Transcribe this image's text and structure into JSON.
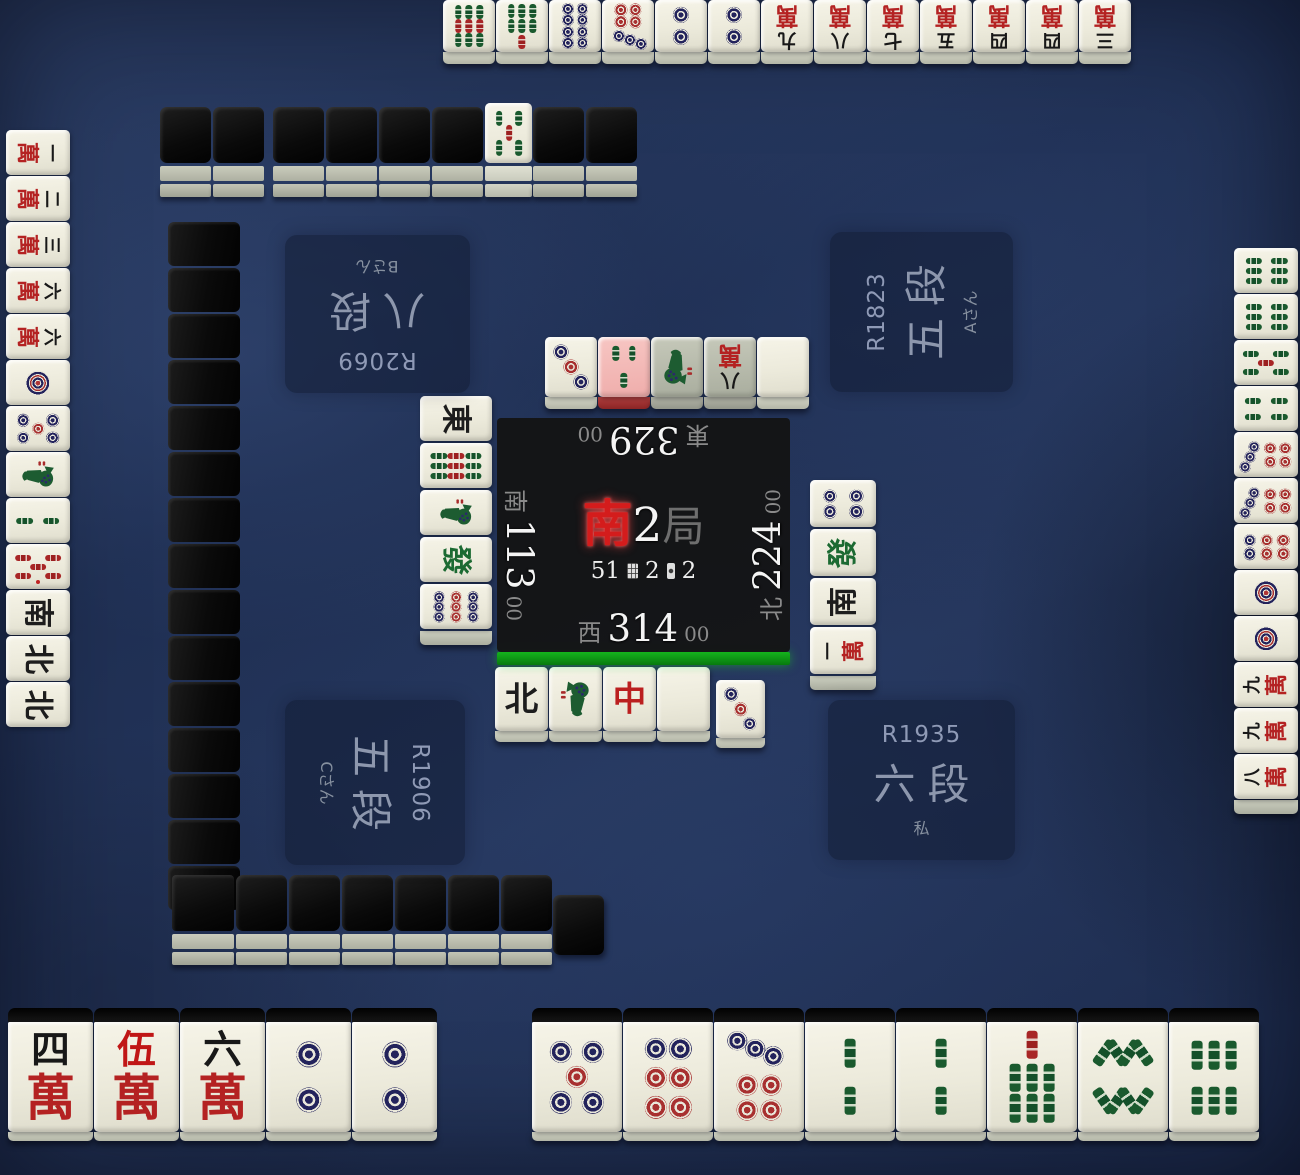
{
  "center": {
    "round": {
      "wind": "南",
      "number": "2",
      "unit": "局"
    },
    "wall_remaining": "51",
    "honba": "2",
    "riichi_sticks": "2"
  },
  "players": {
    "top": {
      "seat_wind": "東",
      "score": "329",
      "score_pad": "00",
      "rate": "R2069",
      "rank": "八段",
      "name": "Bさん"
    },
    "right": {
      "seat_wind": "北",
      "score": "224",
      "score_pad": "00",
      "rate": "R1823",
      "rank": "五段",
      "name": "Aさん"
    },
    "left": {
      "seat_wind": "南",
      "score": "113",
      "score_pad": "00",
      "rate": "R1906",
      "rank": "五段",
      "name": "Cさん"
    },
    "bottom": {
      "seat_wind": "西",
      "score": "314",
      "score_pad": "00",
      "rate": "R1935",
      "rank": "六段",
      "name": "私",
      "active": true
    }
  },
  "hands": {
    "top": [
      "9s",
      "7s",
      "8p",
      "7p",
      "2p",
      "2p",
      "9m",
      "8m",
      "7m",
      "5m",
      "4m",
      "4m",
      "3m"
    ],
    "left": [
      "1m",
      "2m",
      "3m",
      "6m",
      "6m",
      "1p",
      "5p",
      "1s",
      "2s",
      "0s",
      "S",
      "N",
      "N"
    ],
    "right": [
      "6s",
      "6s",
      "5s",
      "4s",
      "7p",
      "7p",
      "6p",
      "1p",
      "1p",
      "9m",
      "9m",
      "8m"
    ],
    "bottom_left_group": [
      "4m",
      "0m",
      "6m",
      "2p",
      "2p"
    ],
    "bottom_right_group": [
      "5p",
      "6p",
      "7p",
      "2s",
      "2s",
      "7s",
      "8s",
      "6s"
    ]
  },
  "discards": {
    "top": [
      {
        "t": "3p"
      },
      {
        "t": "3s",
        "state": "last"
      },
      {
        "t": "1s",
        "state": "dim"
      },
      {
        "t": "8m",
        "state": "dim"
      },
      {
        "t": "haku"
      }
    ],
    "left": [
      {
        "t": "E"
      },
      {
        "t": "9s"
      },
      {
        "t": "1s"
      },
      {
        "t": "hatsu"
      },
      {
        "t": "9p"
      }
    ],
    "right": [
      {
        "t": "4p"
      },
      {
        "t": "hatsu"
      },
      {
        "t": "S"
      },
      {
        "t": "1m"
      }
    ],
    "bottom": [
      {
        "t": "N"
      },
      {
        "t": "1s"
      },
      {
        "t": "chun"
      },
      {
        "t": "haku"
      }
    ],
    "bottom_extra": "3p"
  },
  "wall": {
    "dora_indicator": "5s",
    "top_segment_a": 2,
    "top_segment_b": 4,
    "top_segment_c": 2,
    "left_count": 15,
    "bottom_count": 6,
    "bottom_has_corner": true,
    "bottom_offset_end": true
  }
}
